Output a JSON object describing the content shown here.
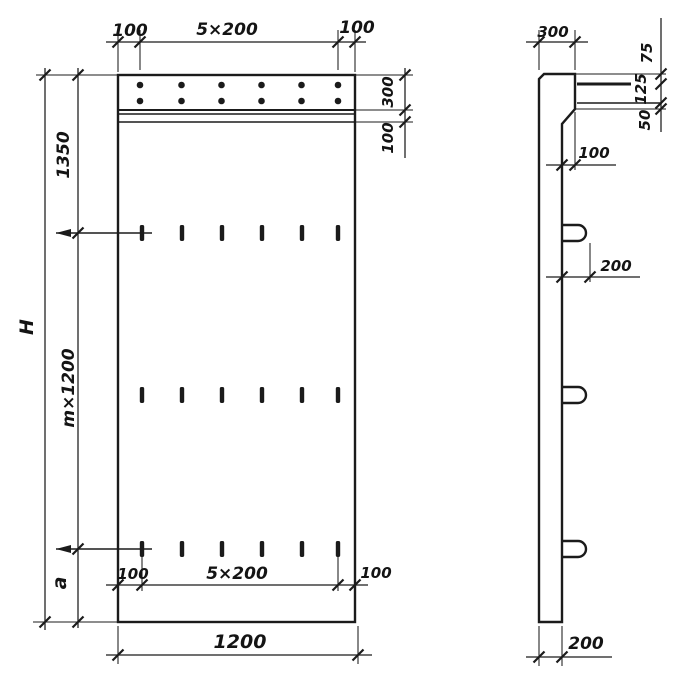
{
  "drawing_type": "concrete-panel-technical-drawing",
  "front_view": {
    "top": {
      "left": "100",
      "center": "5×200",
      "right": "100"
    },
    "left": {
      "overall": "H",
      "top_zone": "1350",
      "module": "m×1200",
      "bottom_zone": "a"
    },
    "right": {
      "cap_height": "300",
      "cap_offset": "100"
    },
    "bottom": {
      "inner_left": "100",
      "inner_center": "5×200",
      "inner_right": "100",
      "overall_width": "1200"
    }
  },
  "side_view": {
    "top": {
      "cap_depth": "300"
    },
    "right": {
      "upper": "75",
      "middle": "125",
      "lower": "50"
    },
    "step": "100",
    "loop": "200",
    "bottom": {
      "thickness": "200"
    }
  }
}
